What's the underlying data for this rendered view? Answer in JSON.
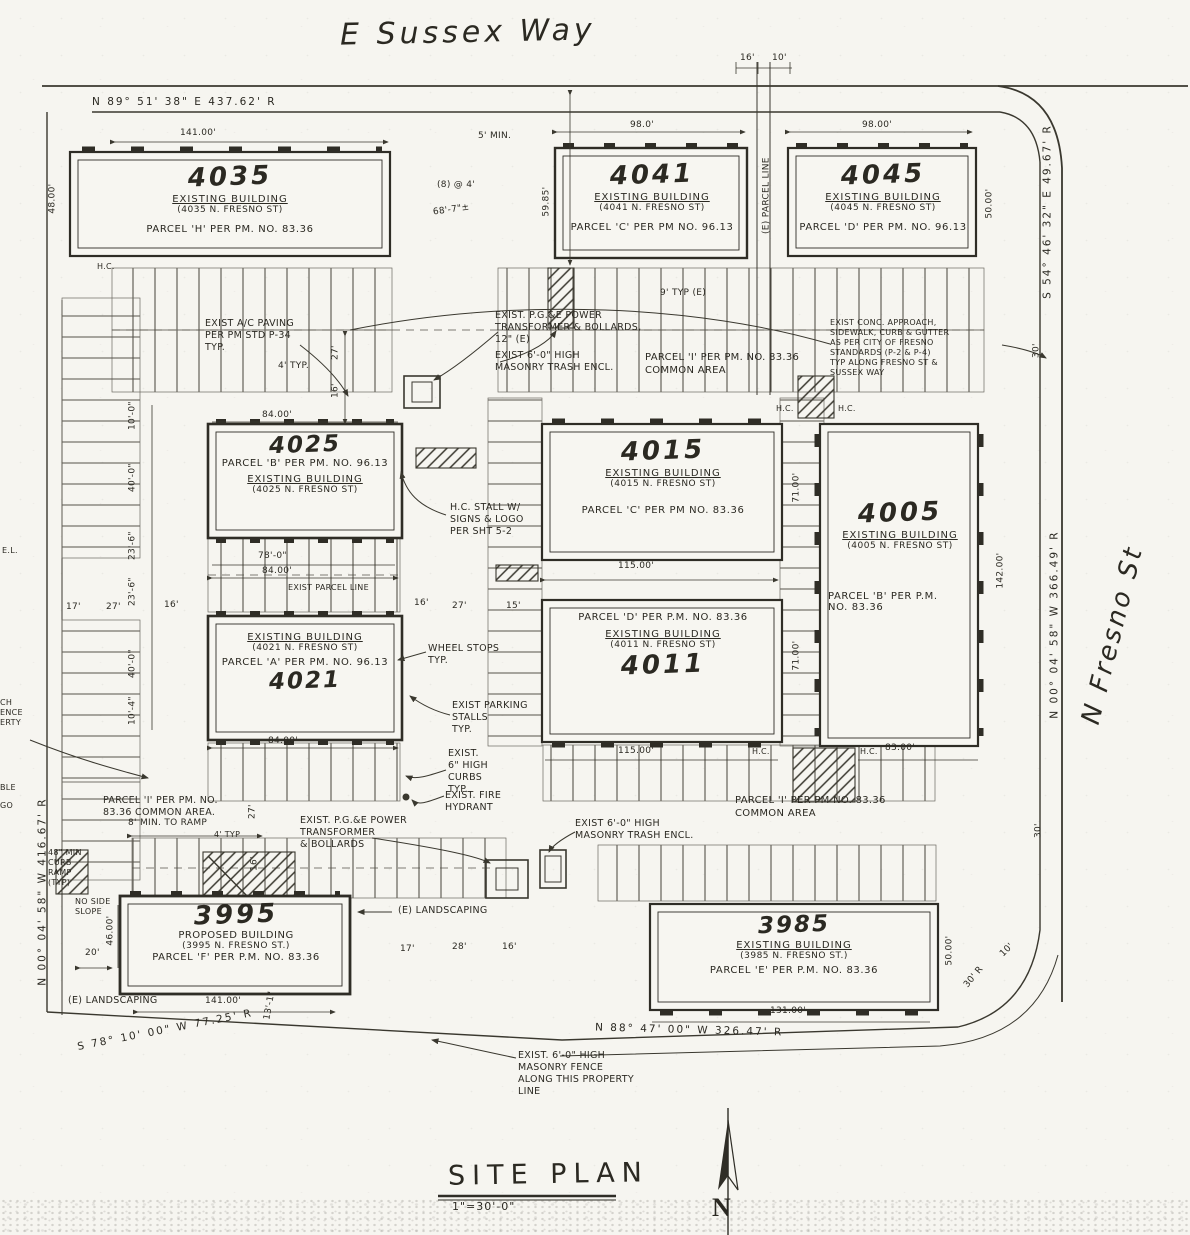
{
  "streets": {
    "top": "E Sussex Way",
    "right": "N Fresno St"
  },
  "titleblock": {
    "title": "SITE PLAN",
    "scale": "1\"=30'-0\"",
    "north": "N"
  },
  "bearings": {
    "top": "N 89° 51' 38\" E   437.62' R",
    "right_upper": "S 54° 46' 32\" E  49.67' R",
    "right_lower": "N 00° 04' 58\" W  366.49' R",
    "left": "N 00° 04' 58\" W  416.67' R",
    "bottom": "N 88° 47' 00\" W   326.47' R",
    "bottom_left": "S 78° 10' 00\" W   77.25' R"
  },
  "buildings": [
    {
      "number": "4035",
      "line1": "EXISTING BUILDING",
      "line2": "(4035 N. FRESNO ST)",
      "parcel": "PARCEL 'H' PER PM. NO. 83.36"
    },
    {
      "number": "4041",
      "line1": "EXISTING BUILDING",
      "line2": "(4041 N. FRESNO ST)",
      "parcel": "PARCEL 'C' PER PM NO. 96.13"
    },
    {
      "number": "4045",
      "line1": "EXISTING BUILDING",
      "line2": "(4045 N. FRESNO ST)",
      "parcel": "PARCEL 'D' PER PM. NO. 96.13"
    },
    {
      "number": "4025",
      "line1": "EXISTING BUILDING",
      "line2": "(4025 N. FRESNO ST)",
      "parcel": "PARCEL 'B' PER PM. NO. 96.13"
    },
    {
      "number": "4021",
      "line1": "EXISTING BUILDING",
      "line2": "(4021 N. FRESNO ST)",
      "parcel": "PARCEL 'A' PER PM. NO. 96.13"
    },
    {
      "number": "4015",
      "line1": "EXISTING BUILDING",
      "line2": "(4015 N. FRESNO ST)",
      "parcel": "PARCEL 'C' PER PM NO. 83.36"
    },
    {
      "number": "4011",
      "line1": "EXISTING BUILDING",
      "line2": "(4011 N. FRESNO ST)",
      "parcel": "PARCEL 'D' PER P.M. NO. 83.36"
    },
    {
      "number": "4005",
      "line1": "EXISTING BUILDING",
      "line2": "(4005 N. FRESNO ST)",
      "parcel": "PARCEL 'B' PER P.M.\nNO. 83.36"
    },
    {
      "number": "3995",
      "line1": "PROPOSED BUILDING",
      "line2": "(3995 N. FRESNO ST.)",
      "parcel": "PARCEL 'F' PER P.M. NO. 83.36"
    },
    {
      "number": "3985",
      "line1": "EXISTING BUILDING",
      "line2": "(3985 N. FRESNO ST.)",
      "parcel": "PARCEL 'E' PER P.M. NO. 83.36"
    }
  ],
  "notes": {
    "ac_paving": "EXIST A/C PAVING\nPER PM STD P-34\nTYP.",
    "pge_top": "EXIST. P.G.&E POWER\nTRANSFORMER & BOLLARDS,\n12\" (E)",
    "trash_top": "EXIST 6'-0\" HIGH\nMASONRY TRASH ENCL.",
    "common_mid": "PARCEL 'I' PER PM. NO. 83.36\nCOMMON AREA",
    "conc": "EXIST CONC. APPROACH,\nSIDEWALK, CURB & GUTTER\nAS PER CITY OF FRESNO\nSTANDARDS (P-2 & P-4)\nTYP ALONG FRESNO ST &\nSUSSEX WAY",
    "hc_stall": "H.C. STALL W/\nSIGNS & LOGO\nPER SHT 5-2",
    "wheel": "WHEEL STOPS\nTYP.",
    "stalls": "EXIST PARKING\nSTALLS\nTYP.",
    "curbs": "EXIST.\n6\" HIGH\nCURBS\nTYP.",
    "hydrant": "EXIST. FIRE\nHYDRANT",
    "common_sw": "PARCEL 'I' PER PM. NO.\n83.36 COMMON AREA.",
    "curb_ramp": "48\" MIN\nCURB\nRAMP\n(TYP)",
    "no_slope": "NO SIDE\nSLOPE",
    "landsc_sw": "(E) LANDSCAPING",
    "pge_bottom": "EXIST. P.G.&E POWER\nTRANSFORMER\n& BOLLARDS",
    "landsc_mid": "(E) LANDSCAPING",
    "trash_bottom": "EXIST 6'-0\" HIGH\nMASONRY TRASH ENCL.",
    "common_se": "PARCEL 'I' PER PM NO. 83.36\nCOMMON AREA",
    "fence_bottom": "EXIST. 6'-0\" HIGH\nMASONRY FENCE\nALONG THIS PROPERTY\nLINE",
    "parcel_line_e": "(E) PARCEL LINE",
    "exist_parcel_line": "EXIST PARCEL LINE",
    "frag_el": "E.L.",
    "frag_fence": "CH\nENCE\nERTY",
    "frag_ble": "BLE",
    "frag_go": "GO"
  },
  "labels": {
    "hc": "H.C."
  },
  "dims": {
    "d141a": "141.00'",
    "d48": "48.00'",
    "d5min": "5' MIN.",
    "d16a": "16'",
    "d10a": "10'",
    "d98a": "98.0'",
    "d98b": "98.00'",
    "d50a": "50.00'",
    "d5985": "59.85'",
    "d8x4": "(8) @ 4'",
    "d687": "68'-7\"±",
    "d9typ": "9' TYP (E)",
    "d84a": "84.00'",
    "d4typa": "4' TYP.",
    "d27a": "27'",
    "d16b": "16'",
    "d780": "78'-0\"",
    "d84b": "84.00'",
    "d84c": "84.00'",
    "d17a": "17'",
    "d27b": "27'",
    "d16c": "16'",
    "d16d": "16'",
    "d27c": "27'",
    "d15": "15'",
    "c10a": "10'-0\"",
    "c40a": "40'-0\"",
    "c236a": "23'-6\"",
    "c236b": "23'-6\"",
    "c40b": "40'-0\"",
    "c104": "10'-4\"",
    "d115a": "115.00'",
    "d71a": "71.00'",
    "d71b": "71.00'",
    "d115b": "115.00'",
    "d83": "83.00'",
    "d142": "142.00'",
    "d30a": "30'",
    "d30b": "30'",
    "d46": "46.00'",
    "d20": "20'",
    "d141b": "141.00'",
    "d13": "13'-1\"",
    "d131": "131.00'",
    "d50b": "50.00'",
    "d30r": "30' R",
    "d10r": "10'",
    "d17b": "17'",
    "d28": "28'",
    "d16e": "16'",
    "d8min": "8' MIN. TO RAMP",
    "d27d": "27'",
    "d16f": "16'",
    "d4typb": "4' TYP"
  }
}
